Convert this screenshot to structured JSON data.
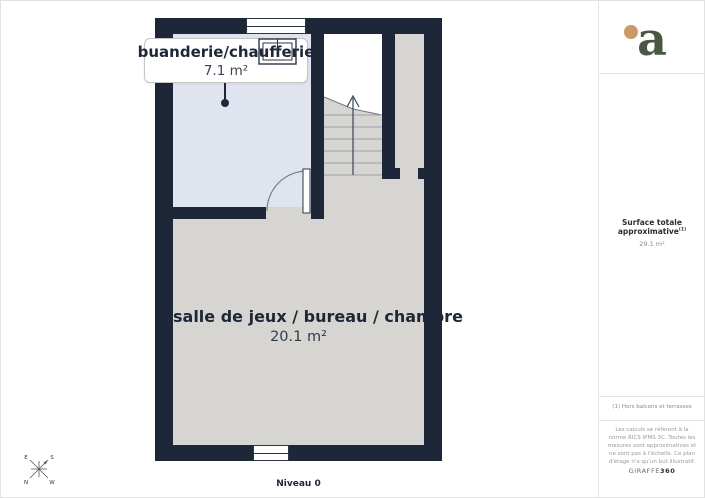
{
  "plan": {
    "level_label": "Niveau 0",
    "rooms": [
      {
        "name": "buanderie/chaufferie",
        "area": "7.1 m²"
      },
      {
        "name": "salle de jeux / bureau / chambre",
        "area": "20.1 m²"
      }
    ],
    "compass": {
      "e": "E",
      "s": "S",
      "n": "N",
      "w": "W"
    }
  },
  "sidebar": {
    "surface_title": "Surface totale approximative",
    "surface_sup": "(1)",
    "surface_value": "29.1 m²",
    "footnote": "(1) Hors balcons et terrasses",
    "disclaimer": "Les calculs se réfèrent à la norme RICS IPMS 3C. Toutes les mesures sont approximatives et ne sont pas à l'échelle. Ce plan d'étage n'a qu'un but illustratif.",
    "brand_name": "GIRAFFE",
    "brand_suffix": "360"
  },
  "colors": {
    "wall": "#1d2737",
    "room_buanderie": "#dfe4ef",
    "room_main": "#d6d5d2",
    "logo_green": "#4a5742",
    "logo_dot": "#cb9868"
  }
}
